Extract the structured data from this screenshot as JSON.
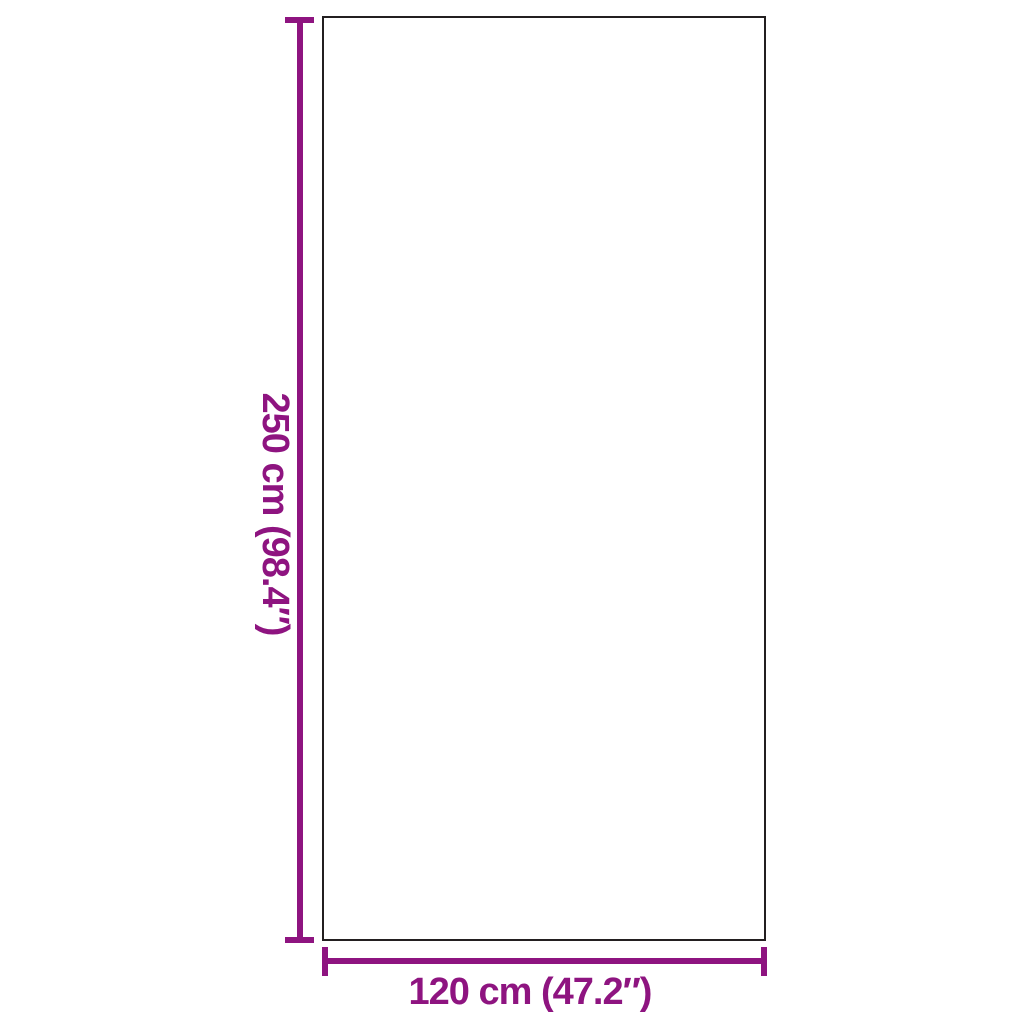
{
  "page": {
    "background_color": "#ffffff"
  },
  "diagram": {
    "type": "product-dimension-diagram",
    "outline_color": "#231f20",
    "dimension_color": "#8E1480",
    "height_dimension": {
      "label": "250 cm (98.4″)",
      "value_cm": 250,
      "value_inches": 98.4,
      "orientation": "vertical"
    },
    "width_dimension": {
      "label": "120 cm (47.2″)",
      "value_cm": 120,
      "value_inches": 47.2,
      "orientation": "horizontal"
    }
  }
}
